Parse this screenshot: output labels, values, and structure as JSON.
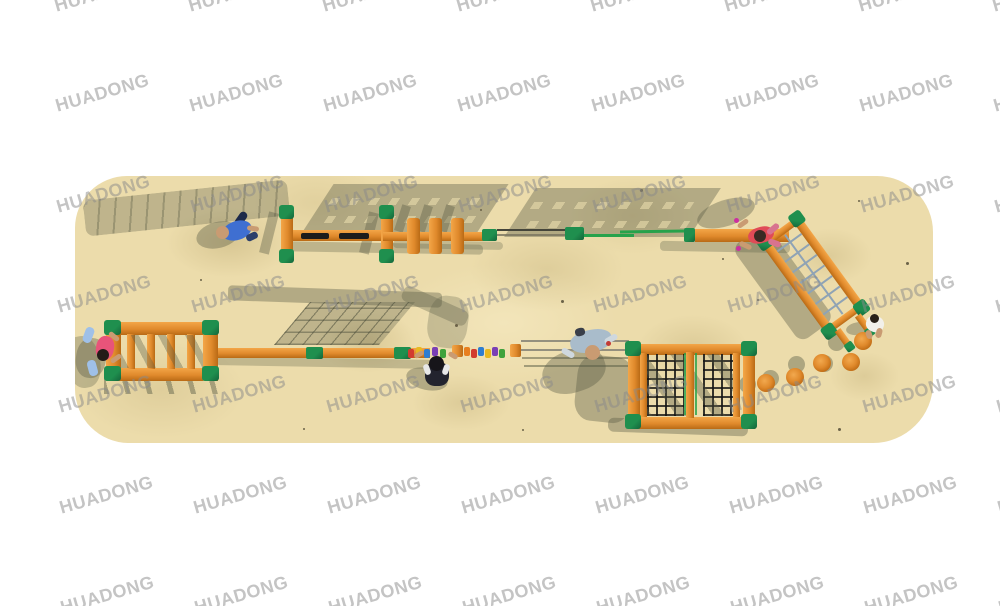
{
  "watermark": {
    "text": "HUADONG",
    "color": "#8a8a8a",
    "opacity": 0.5,
    "rows": 7,
    "cols": 8
  },
  "palette": {
    "background": "#ffffff",
    "sand": "#ecdcab",
    "wood": "#e08a2c",
    "wood_light": "#f3a648",
    "wood_dark": "#b96a15",
    "green": "#1f8f4e",
    "green_dark": "#14643a",
    "shadow": "rgba(86,90,68,0.38)",
    "shadow_dark": "rgba(70,73,55,0.5)",
    "net_blue": "#8fa3b5",
    "net_black": "#1c1c1c",
    "rope_green": "#27a24b",
    "rope_dark": "#45453a",
    "skin": "#c99b72"
  },
  "figures": {
    "crawler_blue": "#3f6fd1",
    "climber_red": "#e04b57",
    "hanger_pink": "#e8547a",
    "walker_dark": "#23242e",
    "crawler_gray": "#a9bccb",
    "walker_white": "#f2f0ea"
  },
  "grips": [
    "#d23b2f",
    "#e8b821",
    "#2e7dd1",
    "#7a3fb5",
    "#3fa23c",
    "#e87f1e",
    "#d23b2f",
    "#2e7dd1",
    "#e8b821",
    "#7a3fb5",
    "#3fa23c"
  ]
}
